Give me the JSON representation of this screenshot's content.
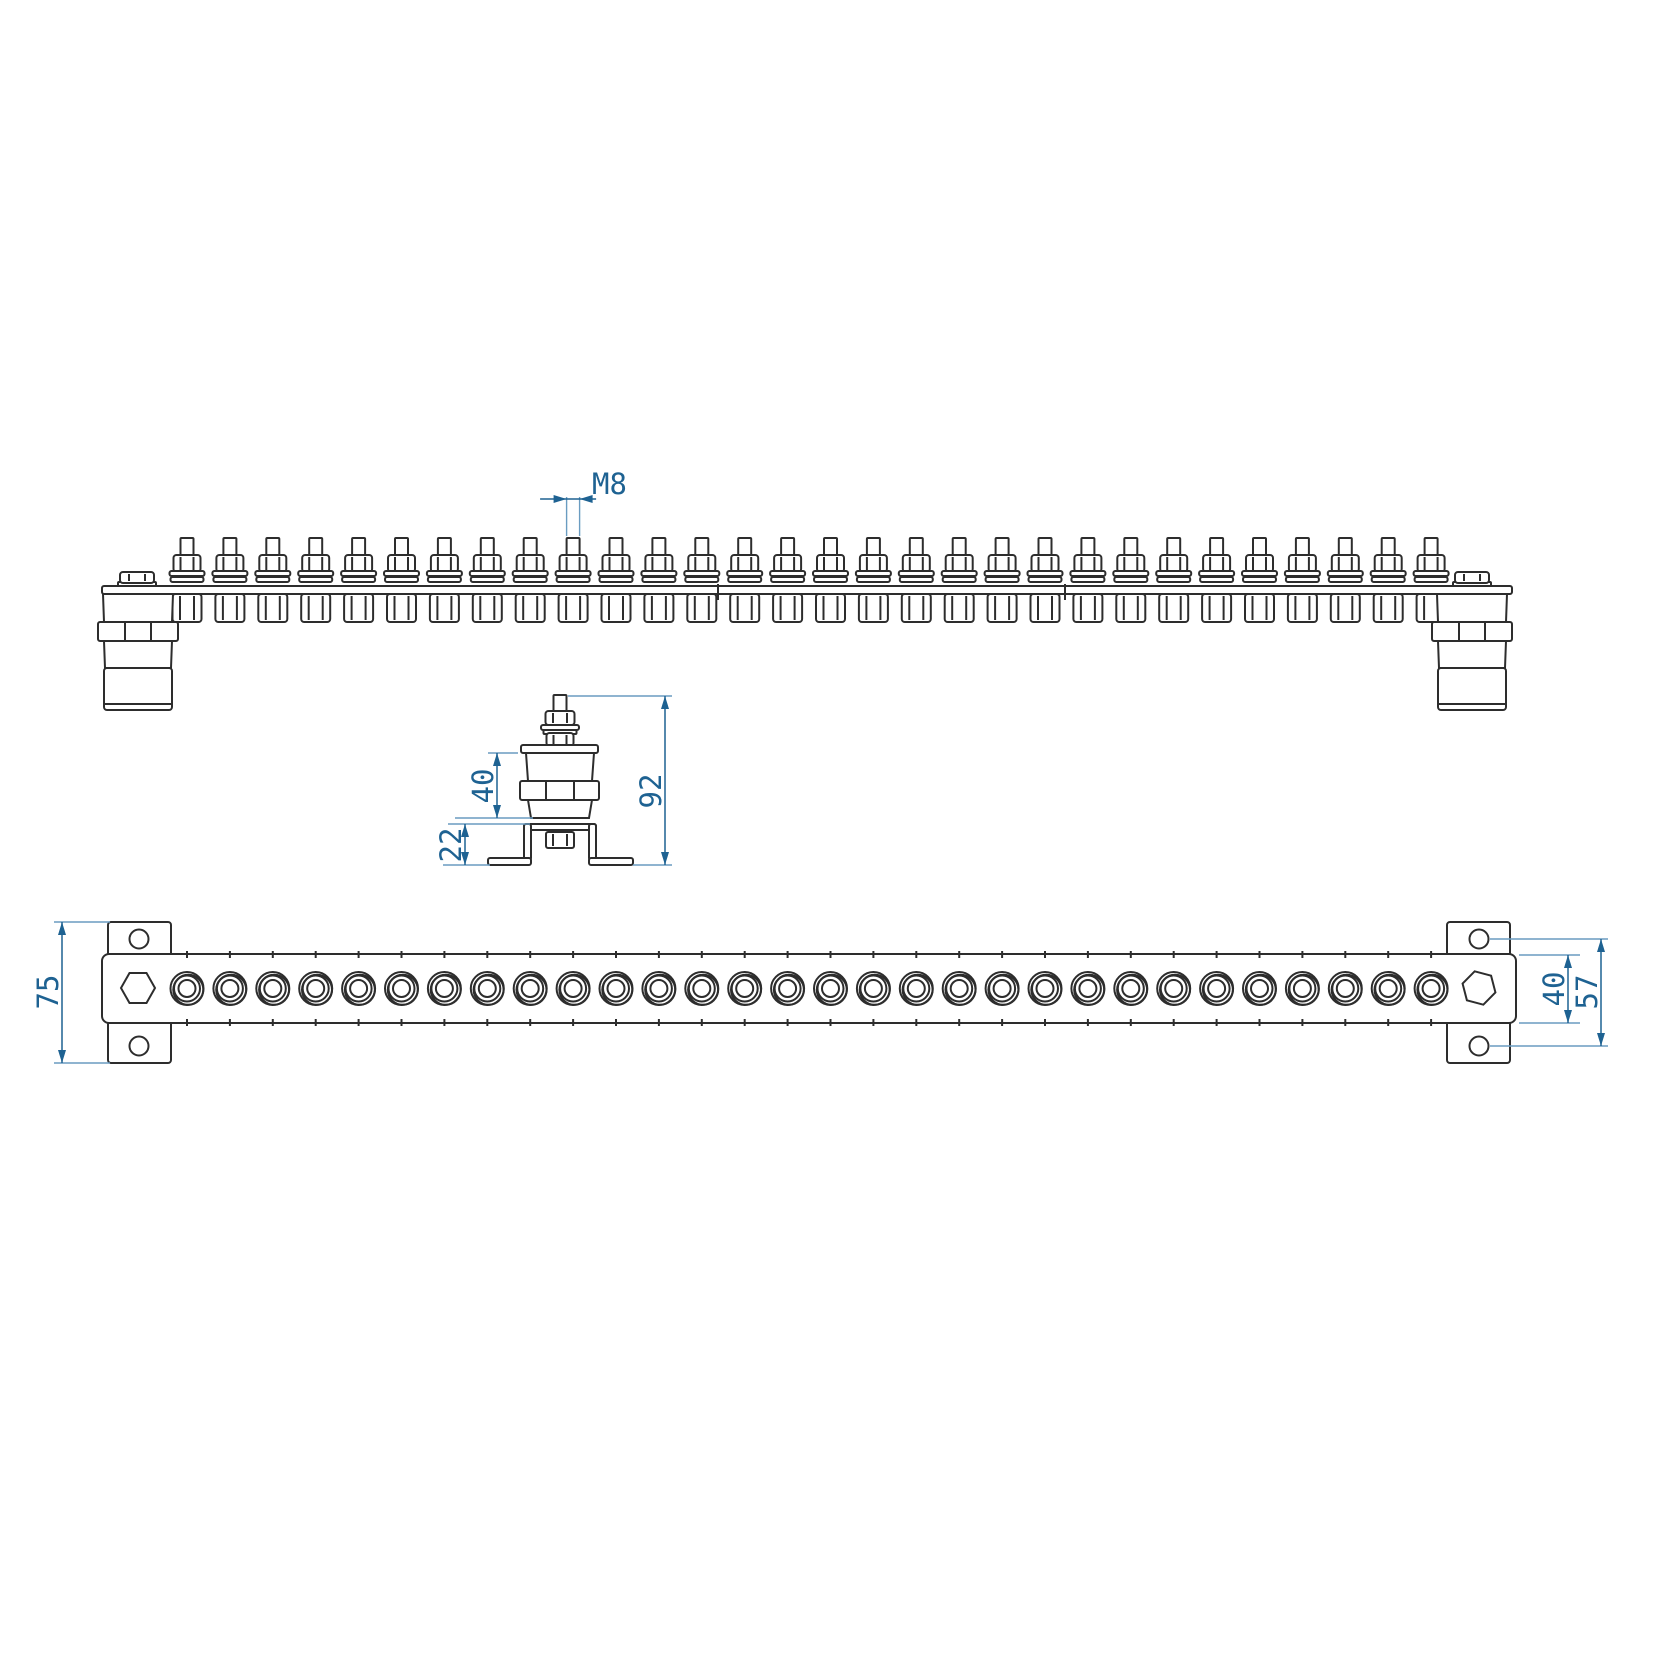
{
  "drawing": {
    "terminal_count": 30,
    "labels": {
      "thread": "M8",
      "insulator_height": "40",
      "overall_height": "92",
      "bracket_height": "22",
      "bracket_plate_height": "75",
      "bar_width": "40",
      "hole_spacing": "57"
    },
    "colors": {
      "line": "#2d2d2d",
      "dimension": "#1e6292",
      "extension": "#6a9cc1",
      "background": "#ffffff"
    }
  }
}
